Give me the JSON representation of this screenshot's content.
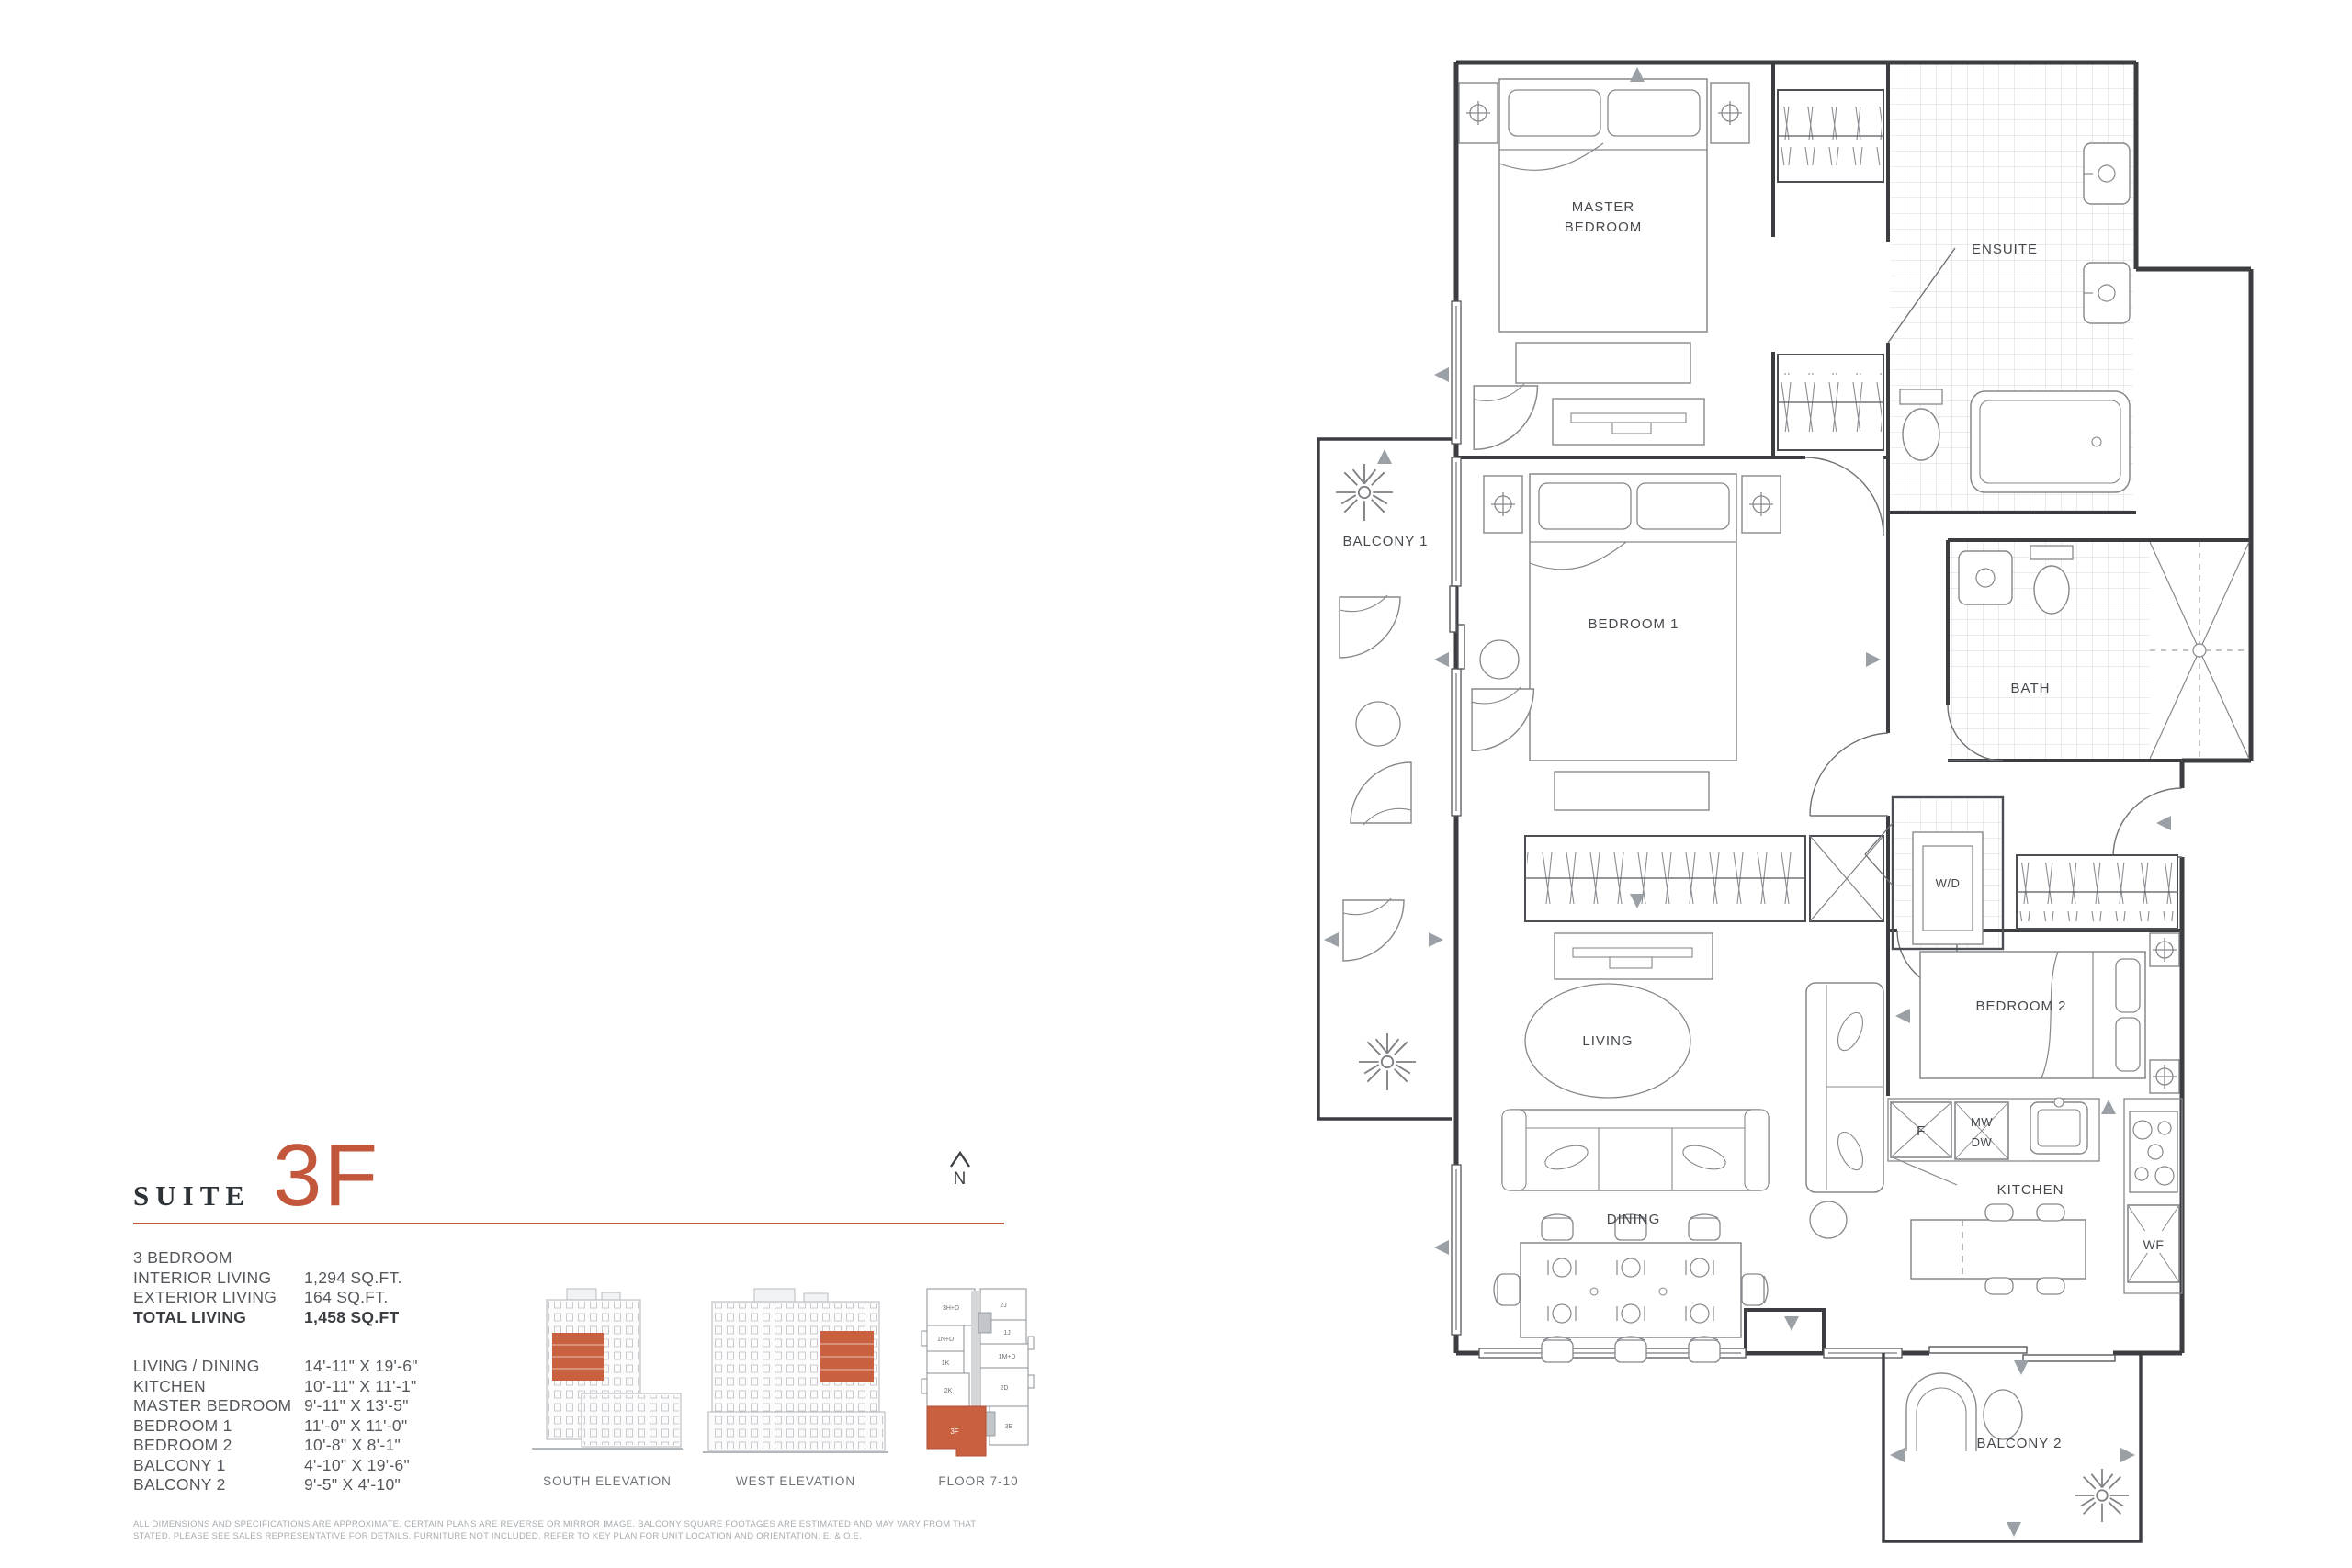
{
  "suite": {
    "word": "SUITE",
    "number": "3F"
  },
  "north": {
    "label": "N"
  },
  "facts": {
    "rows": [
      {
        "label": "3 BEDROOM",
        "value": ""
      },
      {
        "label": "INTERIOR LIVING",
        "value": "1,294 SQ.FT."
      },
      {
        "label": "EXTERIOR LIVING",
        "value": "164 SQ.FT."
      },
      {
        "label": "TOTAL LIVING",
        "value": "1,458 SQ.FT"
      }
    ]
  },
  "dims": {
    "rows": [
      {
        "label": "LIVING / DINING",
        "value": "14'-11\" X 19'-6\""
      },
      {
        "label": "KITCHEN",
        "value": "10'-11\" X 11'-1\""
      },
      {
        "label": "MASTER BEDROOM",
        "value": "9'-11\" X 13'-5\""
      },
      {
        "label": "BEDROOM 1",
        "value": "11'-0\" X 11'-0\""
      },
      {
        "label": "BEDROOM 2",
        "value": "10'-8\" X 8'-1\""
      },
      {
        "label": "BALCONY 1",
        "value": "4'-10\" X 19'-6\""
      },
      {
        "label": "BALCONY 2",
        "value": "9'-5\" X 4'-10\""
      }
    ]
  },
  "figures": {
    "south_caption": "SOUTH ELEVATION",
    "west_caption": "WEST ELEVATION",
    "keyplan_caption": "FLOOR 7-10",
    "keyplan_units": {
      "u1": "3H+D",
      "u2": "2J",
      "u3": "1N+D",
      "u4": "1J",
      "u5": "1M+D",
      "u6": "1K",
      "u7": "2K",
      "u8": "2D",
      "u9": "3F",
      "u10": "3E"
    },
    "highlighted_unit": "3F"
  },
  "plan": {
    "labels": {
      "master_1": "MASTER",
      "master_2": "BEDROOM",
      "ensuite": "ENSUITE",
      "bath": "BATH",
      "bedroom1": "BEDROOM 1",
      "balcony1": "BALCONY 1",
      "wd": "W/D",
      "bedroom2": "BEDROOM 2",
      "living": "LIVING",
      "dining": "DINING",
      "kitchen": "KITCHEN",
      "balcony2": "BALCONY 2",
      "f": "F",
      "mw": "MW",
      "dw": "DW",
      "wf": "WF"
    }
  },
  "disclaimer": "ALL DIMENSIONS AND SPECIFICATIONS ARE APPROXIMATE. CERTAIN PLANS ARE REVERSE OR MIRROR IMAGE. BALCONY SQUARE FOOTAGES ARE ESTIMATED AND MAY VARY FROM THAT STATED. PLEASE SEE SALES REPRESENTATIVE FOR DETAILS. FURNITURE NOT INCLUDED. REFER TO KEY PLAN FOR UNIT LOCATION AND ORIENTATION. E. & O.E.",
  "colors": {
    "accent": "#c2573c",
    "wall": "#3b3d40",
    "furniture": "#85888c"
  }
}
